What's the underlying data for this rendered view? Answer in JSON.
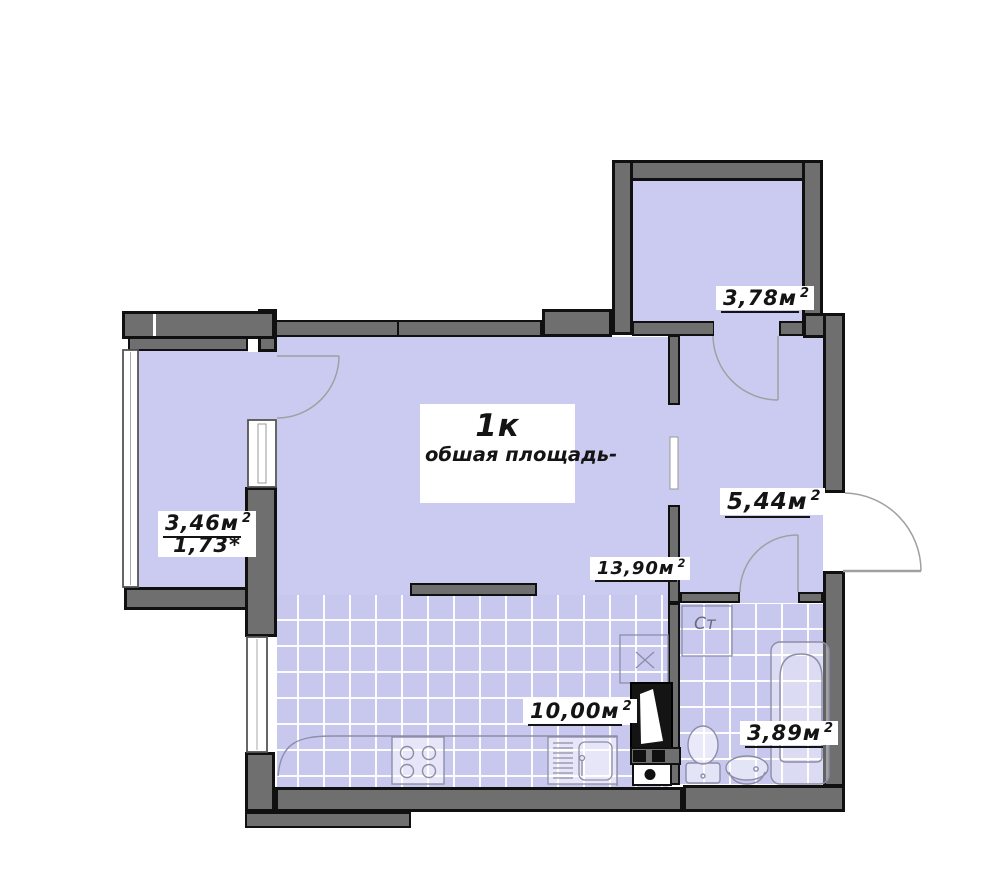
{
  "plan": {
    "unit_label": {
      "line1": "1к",
      "line2": "обшая площадь-"
    },
    "rooms": {
      "top_balcony": {
        "area": "3,78м",
        "sup": "2"
      },
      "left_balcony": {
        "area": "3,46м",
        "sup": "2",
        "reduced": "1,73*"
      },
      "hallway": {
        "area": "5,44м",
        "sup": "2"
      },
      "living_room": {
        "area": "13,90м",
        "sup": "2"
      },
      "kitchen": {
        "area": "10,00м",
        "sup": "2"
      },
      "bathroom": {
        "area": "3,89м",
        "sup": "2"
      }
    },
    "fixtures": {
      "washing_machine_label": "Ст"
    },
    "colors": {
      "floor": "#cbcbf1",
      "wall": "#6f6f6f",
      "outline": "#101010",
      "tile_line": "#ffffff",
      "fixture_stroke": "#8d8da8",
      "door_arc": "#a0a0a0"
    }
  }
}
